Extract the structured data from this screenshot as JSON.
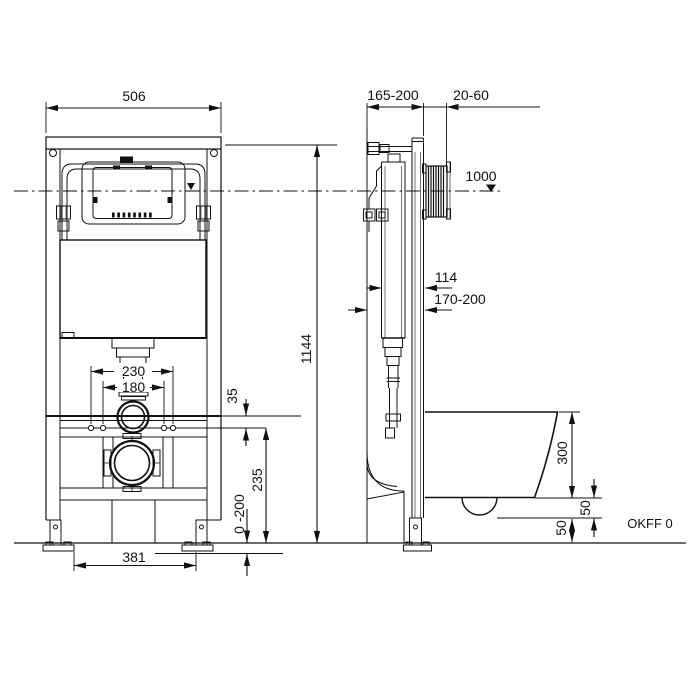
{
  "drawing": {
    "dimensions": {
      "frame_width": "506",
      "frame_height": "1144",
      "depth_adjust": "165-200",
      "wall_cover": "20-60",
      "actuation_height": "1000",
      "cistern_depth": "114",
      "front_depth": "170-200",
      "flush_pipe_span": "230",
      "fixing_bolt_span": "180",
      "rail_to_bolts": "35",
      "bolt_height": "235",
      "leg_extension": "0 -200",
      "foot_span": "381",
      "bowl_height": "300",
      "bowl_clearance": "50",
      "outlet_clearance": "50"
    },
    "labels": {
      "floor_datum": "OKFF 0"
    }
  }
}
